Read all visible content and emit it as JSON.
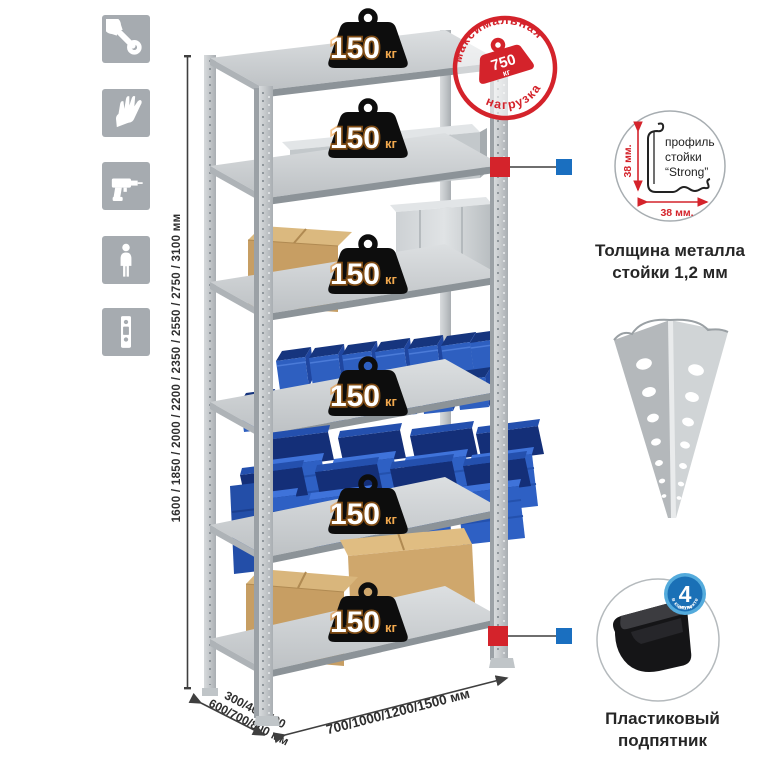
{
  "sidebar_icons": {
    "items": [
      {
        "name": "wrench-icon"
      },
      {
        "name": "gloves-icon"
      },
      {
        "name": "drill-icon"
      },
      {
        "name": "person-icon"
      },
      {
        "name": "post-strip-icon"
      }
    ]
  },
  "dimensions": {
    "height": "1600 / 1850 / 2000 / 2200 / 2350 / 2550 / 2750 / 3100 мм",
    "depth_line1": "300/400/500",
    "depth_line2": "600/700/800 мм",
    "width": "700/1000/1200/1500 мм"
  },
  "shelf_weight": {
    "value": "150",
    "unit": "кг"
  },
  "max_load_stamp": {
    "arc_top": "максимальная",
    "arc_bottom": "нагрузка",
    "value": "750",
    "unit": "кг"
  },
  "profile_detail": {
    "vertical_dim": "38 мм.",
    "horizontal_dim": "38 мм.",
    "label_line1": "профиль",
    "label_line2": "стойки",
    "label_line3": "“Strong”",
    "caption_line1": "Толщина металла",
    "caption_line2": "стойки 1,2 мм"
  },
  "foot_detail": {
    "badge_number": "4",
    "badge_sub": "штуки",
    "badge_arc": "в комплекте",
    "caption_line1": "Пластиковый",
    "caption_line2": "подпятник"
  },
  "colors": {
    "accent_red": "#d4232b",
    "accent_blue": "#1a6fc0",
    "icon_gray": "#a6abb0",
    "bin_blue": "#2e5fc0",
    "metal_gray": "#c7cbce",
    "cardboard": "#c79e63",
    "weight_black": "#111111"
  }
}
